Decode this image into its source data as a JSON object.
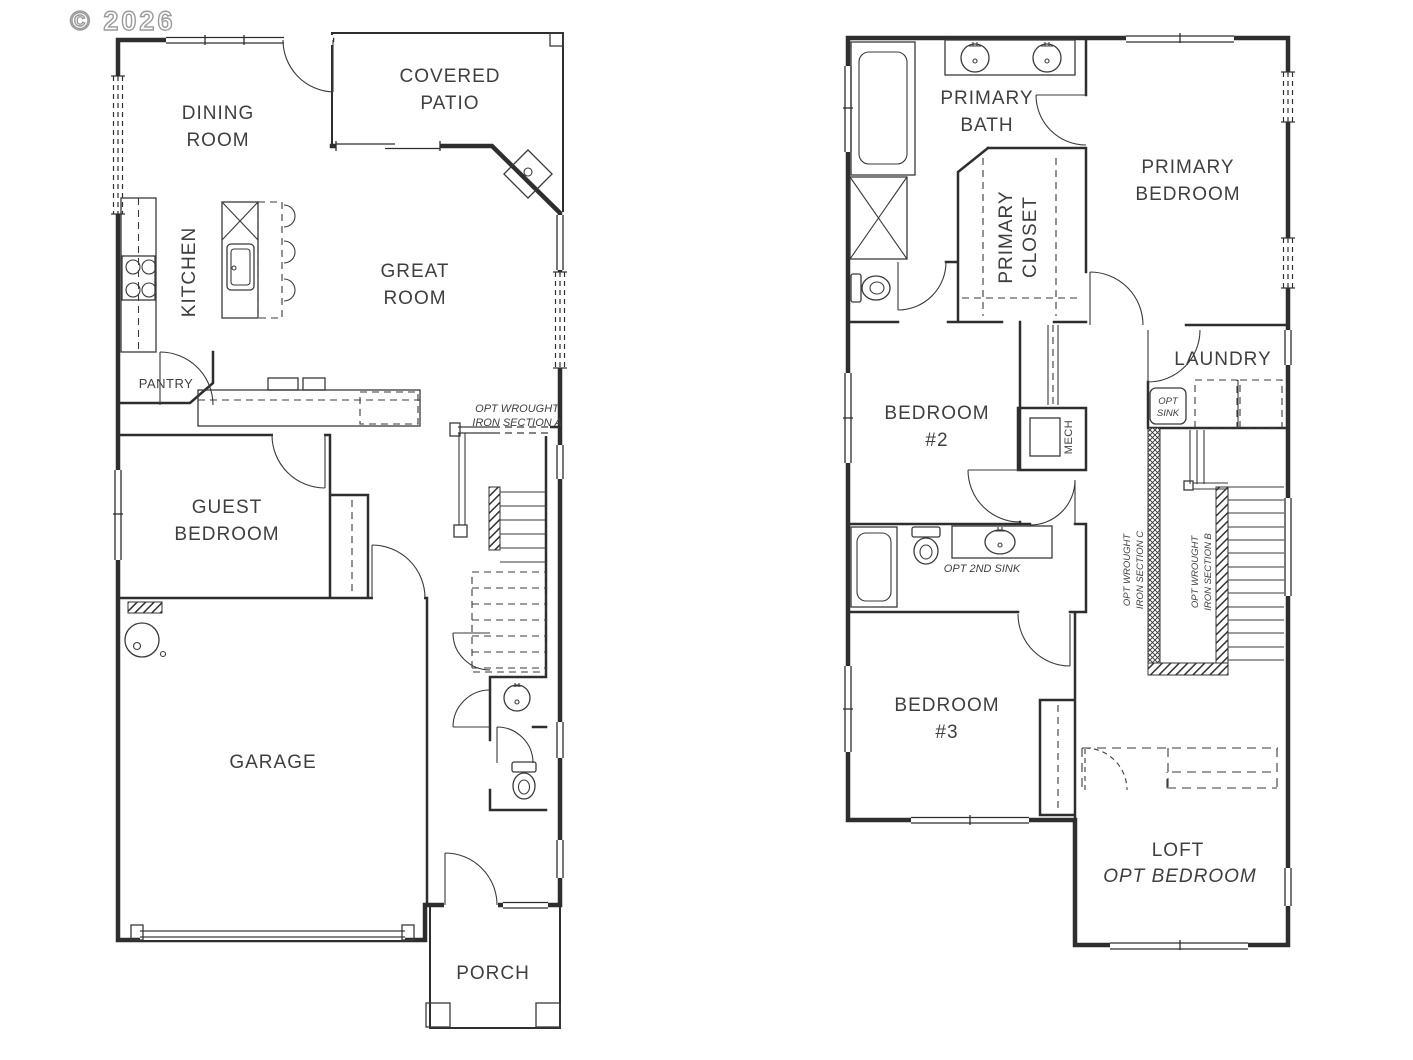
{
  "watermark": "© 2026",
  "colors": {
    "wall": "#2e2e2e",
    "label_text": "#3f3f3f",
    "watermark_gray": "#9a9a9a",
    "background": "#ffffff"
  },
  "floor1": {
    "dining": [
      "DINING",
      "ROOM"
    ],
    "covered_patio": [
      "COVERED",
      "PATIO"
    ],
    "kitchen": "KITCHEN",
    "great_room": [
      "GREAT",
      "ROOM"
    ],
    "pantry": "PANTRY",
    "iron_a": [
      "OPT WROUGHT",
      "IRON SECTION A"
    ],
    "guest": [
      "GUEST",
      "BEDROOM"
    ],
    "garage": "GARAGE",
    "porch": "PORCH"
  },
  "floor2": {
    "primary_bath": [
      "PRIMARY",
      "BATH"
    ],
    "primary_closet": [
      "PRIMARY",
      "CLOSET"
    ],
    "primary_bedroom": [
      "PRIMARY",
      "BEDROOM"
    ],
    "bedroom2": [
      "BEDROOM",
      "#2"
    ],
    "laundry": "LAUNDRY",
    "opt_sink": [
      "OPT",
      "SINK"
    ],
    "mech": "MECH",
    "iron_c": [
      "OPT WROUGHT",
      "IRON SECTION C"
    ],
    "iron_b": [
      "OPT WROUGHT",
      "IRON SECTION B"
    ],
    "opt_2nd_sink": "OPT 2ND SINK",
    "bedroom3": [
      "BEDROOM",
      "#3"
    ],
    "loft": [
      "LOFT",
      "OPT BEDROOM"
    ]
  }
}
